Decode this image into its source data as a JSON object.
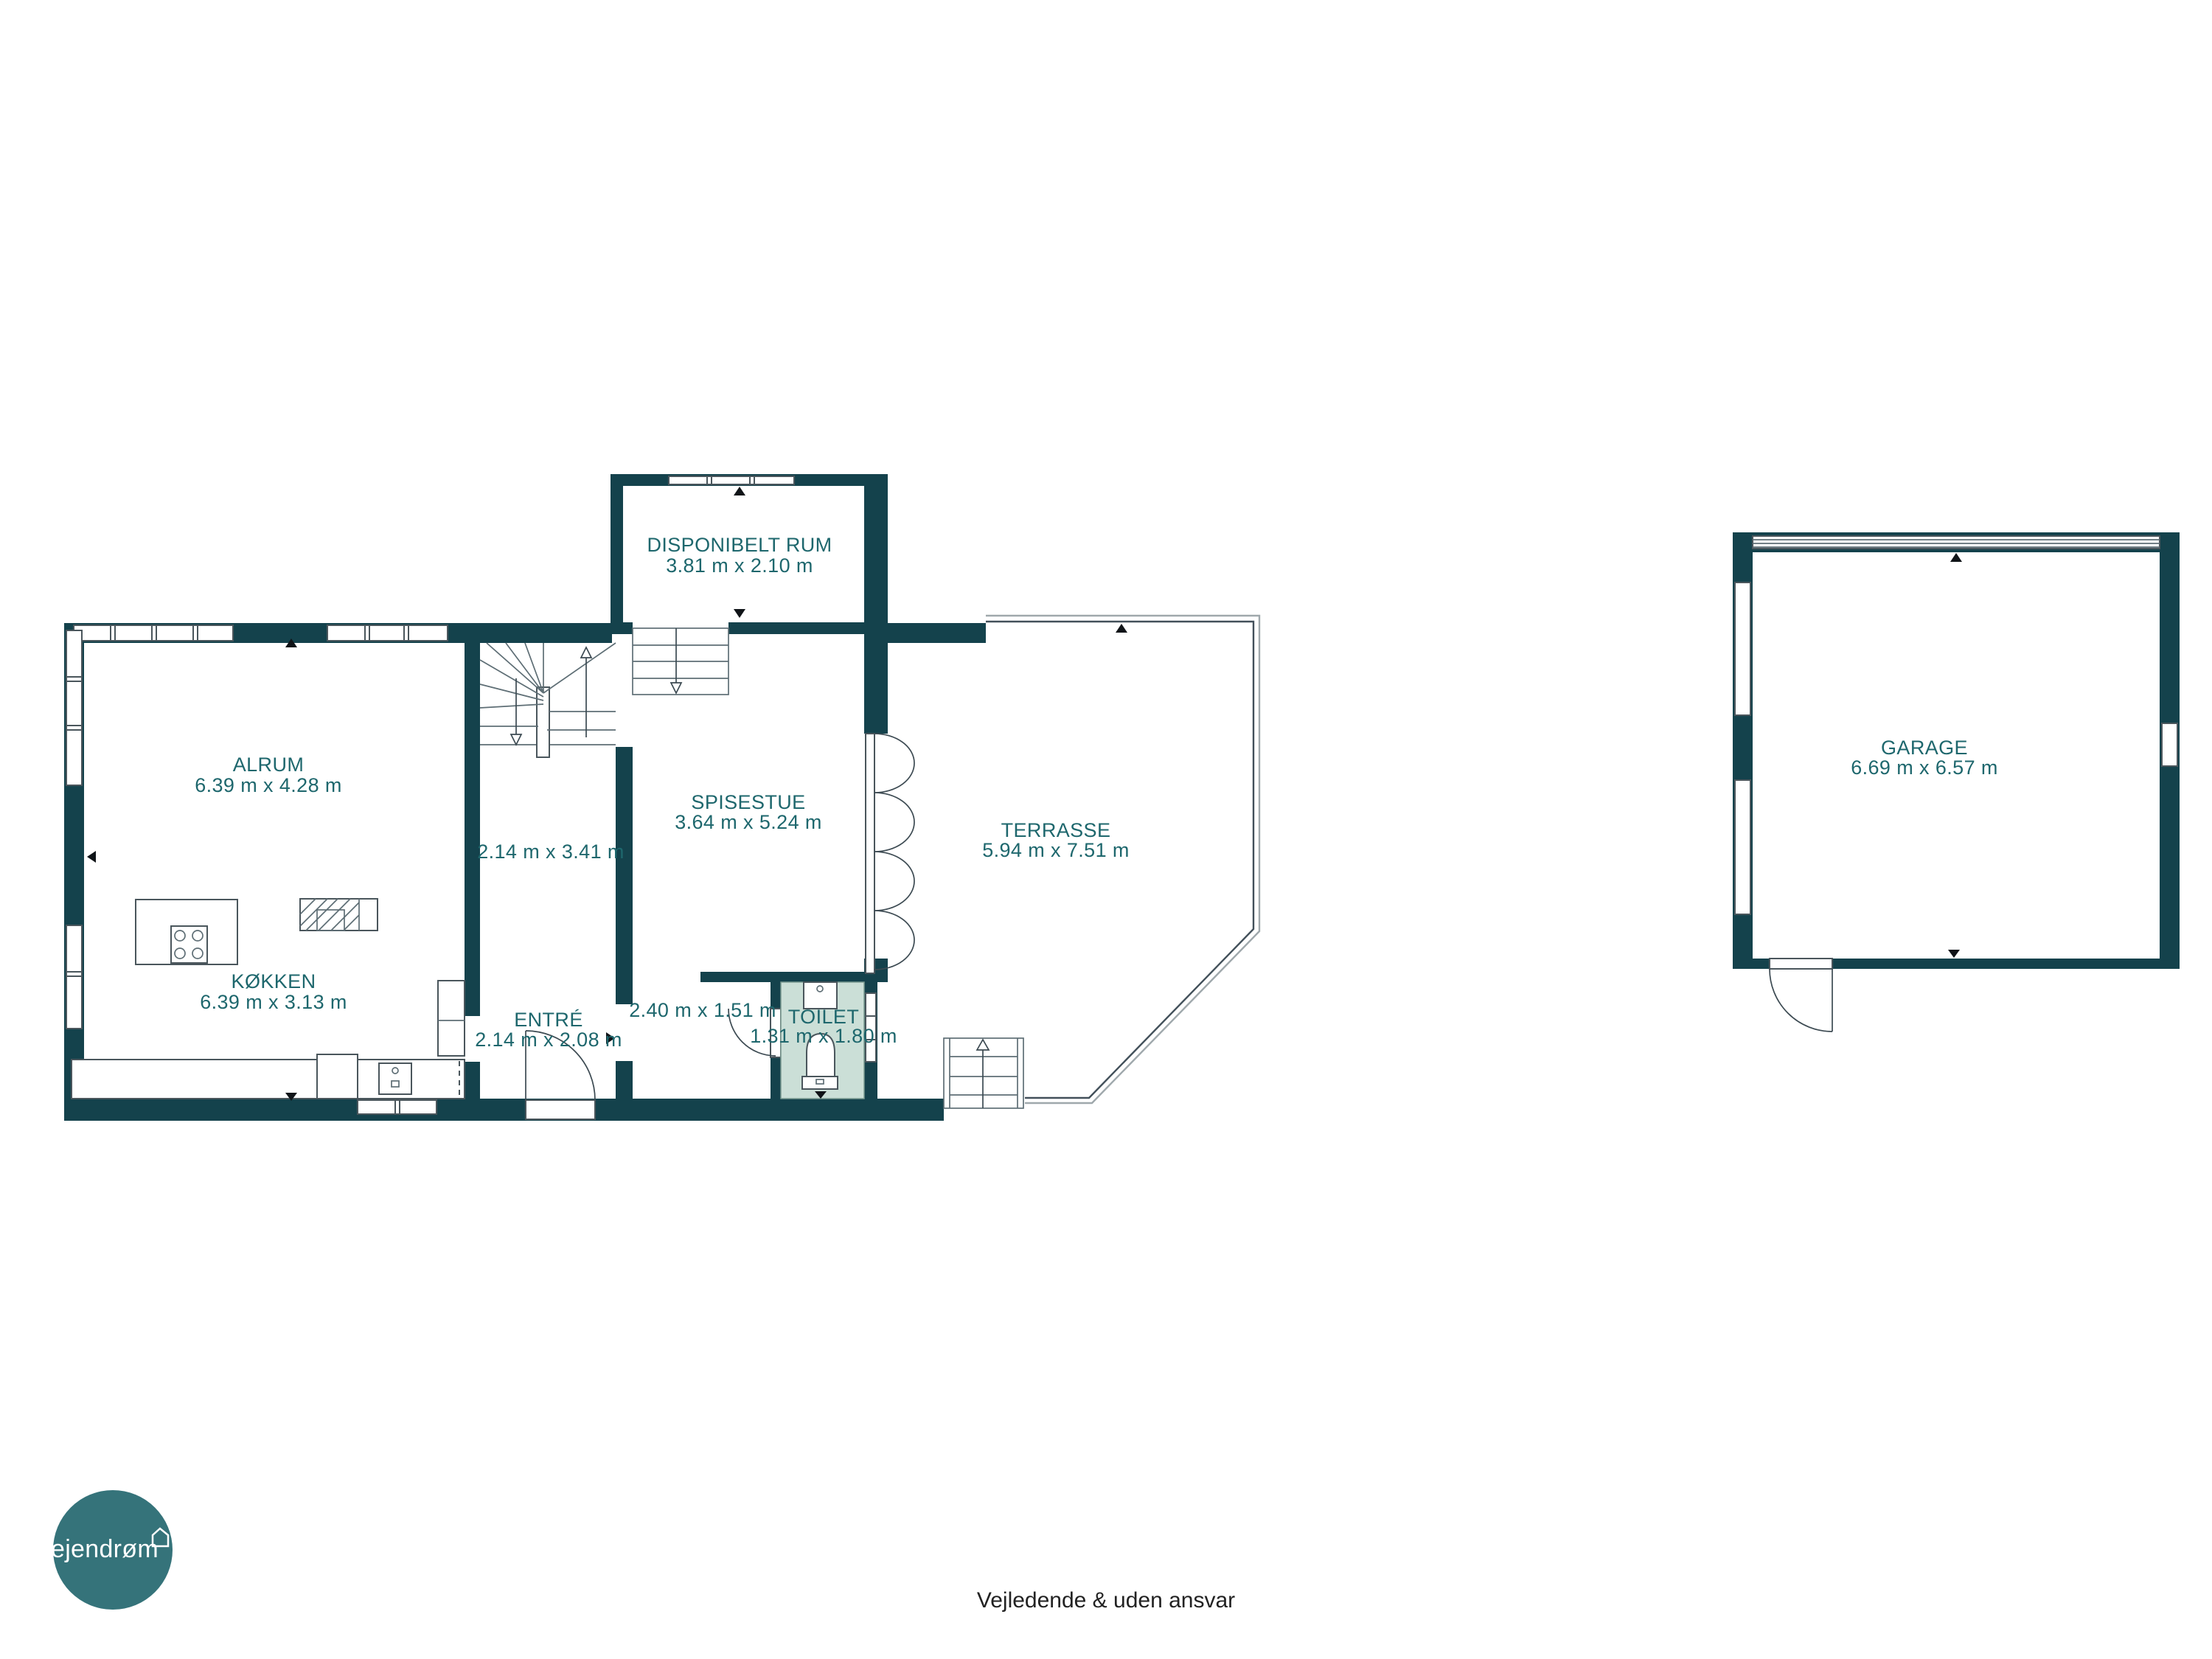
{
  "floorplan": {
    "rooms": [
      {
        "name": "ALRUM",
        "dims": "6.39 m x 4.28 m"
      },
      {
        "name": "KØKKEN",
        "dims": "6.39 m x 3.13 m"
      },
      {
        "name": "ENTRÉ",
        "dims": "2.14 m x 2.08 m"
      },
      {
        "name": "",
        "dims": "2.14 m x 3.41 m"
      },
      {
        "name": "",
        "dims": "2.40 m x 1.51 m"
      },
      {
        "name": "TOILET",
        "dims": "1.31 m x 1.80 m"
      },
      {
        "name": "SPISESTUE",
        "dims": "3.64 m x 5.24 m"
      },
      {
        "name": "DISPONIBELT RUM",
        "dims": "3.81 m x 2.10 m"
      },
      {
        "name": "TERRASSE",
        "dims": "5.94 m x 7.51 m"
      },
      {
        "name": "GARAGE",
        "dims": "6.69 m x 6.57 m"
      }
    ],
    "colors": {
      "wall": "#14424c",
      "room_label": "#1e676d",
      "toilet_floor": "#cbdfd7",
      "logo_background": "#35737a",
      "fixture_outline": "#4a565c"
    }
  },
  "logo": {
    "text": "ejendrøm"
  },
  "footer": {
    "disclaimer": "Vejledende & uden ansvar"
  }
}
